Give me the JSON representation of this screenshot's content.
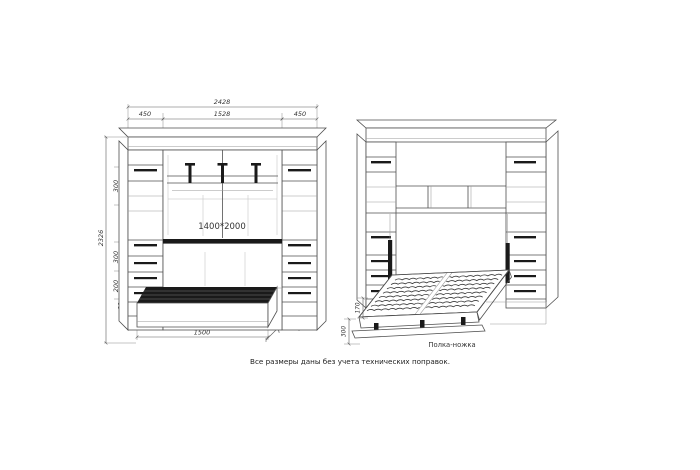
{
  "title": "wall-bed cabinet technical drawing",
  "footer": {
    "note": "Все размеры даны без учета технических поправок."
  },
  "closed_view": {
    "bed_size_label": "1400*2000",
    "dims": {
      "total_width": "2428",
      "left_section_width": "450",
      "center_width": "1528",
      "right_section_width": "450",
      "total_height": "2326",
      "upper_shelf_spacing": "300",
      "mid_shelf_spacing": "300",
      "drawer_section_height": "200",
      "plinth_height": "80",
      "base_width": "1500",
      "base_depth": "750",
      "side_depth": "450"
    }
  },
  "open_view": {
    "labels": {
      "shelf_leg": "Полка-ножка"
    },
    "dims": {
      "frame_thickness": "170",
      "leg_height": "300"
    }
  },
  "colors": {
    "background": "#ffffff",
    "line": "#4f4f4f",
    "dark_fill": "#1a1a1a",
    "text": "#333333"
  }
}
